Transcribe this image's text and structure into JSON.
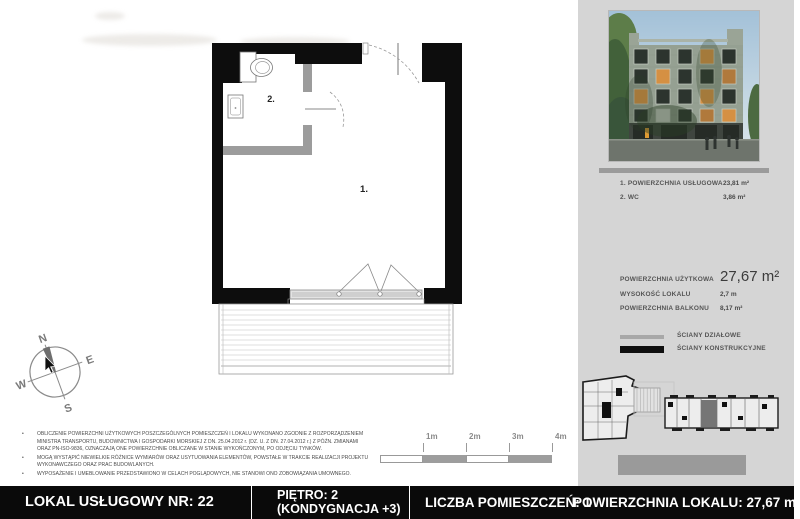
{
  "disclaimer": {
    "marker": "•",
    "bullets": [
      "OBLICZENIE POWIERZCHNI UŻYTKOWYCH POSZCZEGÓLNYCH POMIESZCZEŃ I LOKALU WYKONANO ZGODNIE Z ROZPORZĄDZENIEM MINISTRA TRANSPORTU, BUDOWNICTWA I GOSPODARKI MORSKIEJ Z DN. 25.04.2012 r. (DZ. U. Z DN. 27.04.2012 r.) Z PÓŹN. ZMIANAMI ORAZ PN-ISO-9836, OZNACZAJĄ ONE POWIERZCHNIE OBLICZANE W STANIE WYKOŃCZONYM, PO ODJĘCIU TYNKÓW.",
      "MOGĄ WYSTĄPIĆ NIEWIELKIE RÓŻNICE WYMIARÓW ORAZ USYTUOWANIA ELEMENTÓW, POWSTAŁE W TRAKCIE REALIZACJI PROJEKTU WYKONAWCZEGO ORAZ PRAC BUDOWLANYCH.",
      "WYPOSAŻENIE I UMEBLOWANIE PRZEDSTAWIONO W CELACH POGLĄDOWYCH, NIE STANOWI ONO ZOBOWIĄZANIA UMOWNEGO."
    ]
  },
  "plan": {
    "room1_label": "1.",
    "room2_label": "2."
  },
  "scale_bar": {
    "ticks": [
      "1m",
      "2m",
      "3m",
      "4m"
    ]
  },
  "compass": {
    "north": "N",
    "east": "E",
    "south": "S",
    "west": "W"
  },
  "panel": {
    "room_table": [
      {
        "name": "1. POWIERZCHNIA USŁUGOWA",
        "value": "23,81 m²"
      },
      {
        "name": "2. WC",
        "value": "3,86 m²"
      }
    ],
    "stats": {
      "usable_area_label": "POWIERZCHNIA UŻYTKOWA",
      "usable_area_value": "27,67 m²",
      "height_label": "WYSOKOŚĆ LOKALU",
      "height_value": "2,7 m",
      "balcony_label": "POWIERZCHNIA BALKONU",
      "balcony_value": "8,17 m²"
    },
    "wall_legend": {
      "partition_label": "ŚCIANY DZIAŁOWE",
      "structural_label": "ŚCIANY KONSTRUKCYJNE"
    }
  },
  "footer": {
    "unit_label": "LOKAL USŁUGOWY NR: 22",
    "floor_label": "PIĘTRO: 2",
    "storey_label": "(KONDYGNACJA +3)",
    "room_count_label": "LICZBA POMIESZCZEŃ: 1",
    "total_area_label": "POWIERZCHNIA LOKALU: 27,67 m²"
  },
  "colors": {
    "panel_bg": "#d5d5d5",
    "footer_bg": "#0a0a0a",
    "structural_wall": "#0d0d0d",
    "partition_wall": "#9c9c9c",
    "divider_bar": "#9b9b9b"
  }
}
